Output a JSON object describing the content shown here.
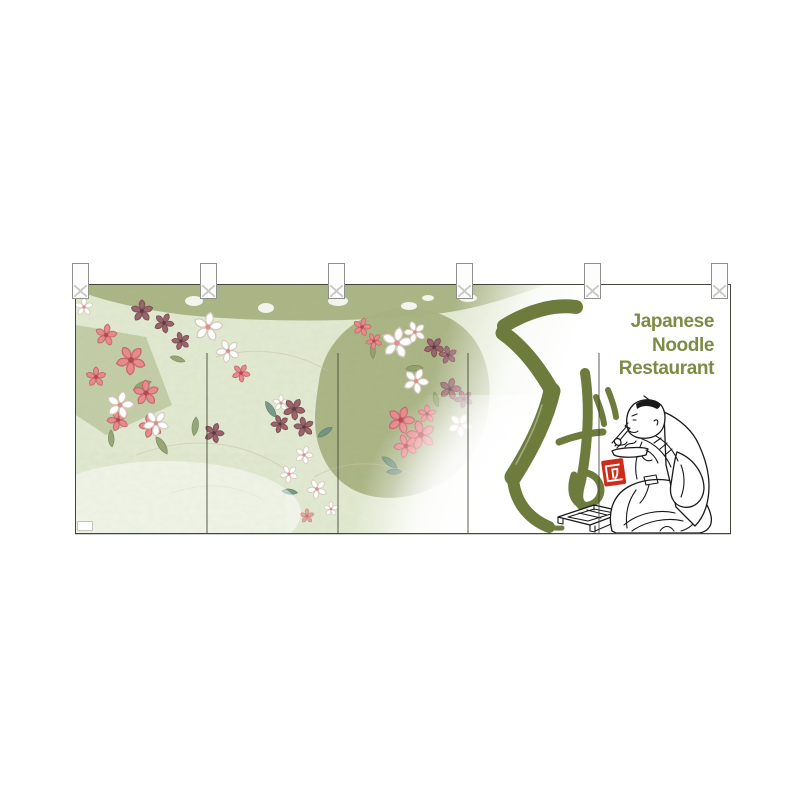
{
  "noren": {
    "english_lines": [
      "Japanese",
      "Noodle",
      "Restaurant"
    ],
    "calligraphy_text": "そば",
    "seal_text": "匠",
    "colors": {
      "text_green": "#7c8c44",
      "calligraphy_green": "#6d7c3c",
      "seal_red": "#cf2b1b",
      "fabric_base_green": "#e2ead3",
      "pattern_olive": "#a4af7d",
      "flower_pink": "#e8898c",
      "flower_mauve": "#99656b",
      "line_black": "#1a1a1a"
    }
  }
}
